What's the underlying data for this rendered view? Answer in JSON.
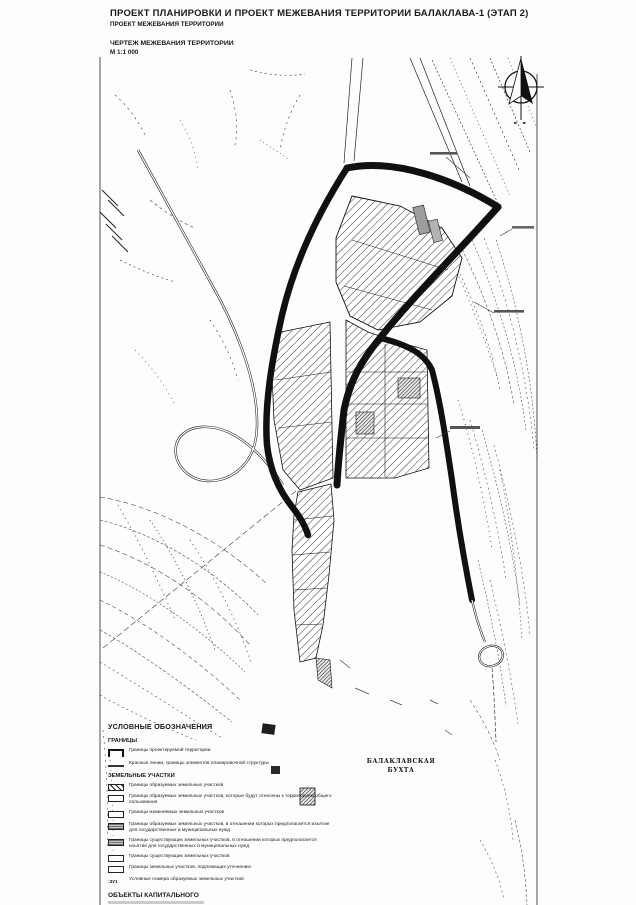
{
  "page": {
    "title": "ПРОЕКТ ПЛАНИРОВКИ И ПРОЕКТ МЕЖЕВАНИЯ ТЕРРИТОРИИ БАЛАКЛАВА-1 (ЭТАП 2)",
    "subtitle": "ПРОЕКТ МЕЖЕВАНИЯ ТЕРРИТОРИИ",
    "drawing_title": "ЧЕРТЕЖ МЕЖЕВАНИЯ ТЕРРИТОРИИ",
    "scale": "М 1:1 000"
  },
  "map": {
    "bay_label_line1": "БАЛАКЛАВСКАЯ",
    "bay_label_line2": "БУХТА"
  },
  "legend": {
    "title": "УСЛОВНЫЕ ОБОЗНАЧЕНИЯ",
    "sections": [
      {
        "heading": "ГРАНИЦЫ",
        "items": [
          {
            "symbol": "project-boundary-bracket",
            "label": "Границы проектируемой территории"
          },
          {
            "symbol": "red-line",
            "label": "Красные линии, границы элементов планировочной структуры"
          }
        ]
      },
      {
        "heading": "ЗЕМЕЛЬНЫЕ УЧАСТКИ",
        "items": [
          {
            "symbol": "hatch-box",
            "label": "Границы образуемых земельных участков"
          },
          {
            "symbol": "white-box",
            "label": "Границы образуемых земельных участков, которые будут отнесены к территориям общего пользования"
          },
          {
            "symbol": "white-box",
            "label": "Границы изменяемых земельных участков"
          },
          {
            "symbol": "gray-box",
            "label": "Границы образуемых земельных участков, в отношении которых предполагается изъятие для государственных и муниципальных нужд"
          },
          {
            "symbol": "gray-box",
            "label": "Границы существующих земельных участков, в отношении которых предполагается изъятие для государственных и муниципальных нужд"
          },
          {
            "symbol": "white-box",
            "label": "Границы существующих земельных участков"
          },
          {
            "symbol": "white-box",
            "label": "Границы земельных участков, подлежащих уточнению"
          },
          {
            "symbol": "zu-number",
            "symbol_text": ":ЗУ1",
            "label": "Условные номера образуемых земельных участков"
          }
        ]
      }
    ],
    "footer_heading": "ОБЪЕКТЫ КАПИТАЛЬНОГО"
  }
}
